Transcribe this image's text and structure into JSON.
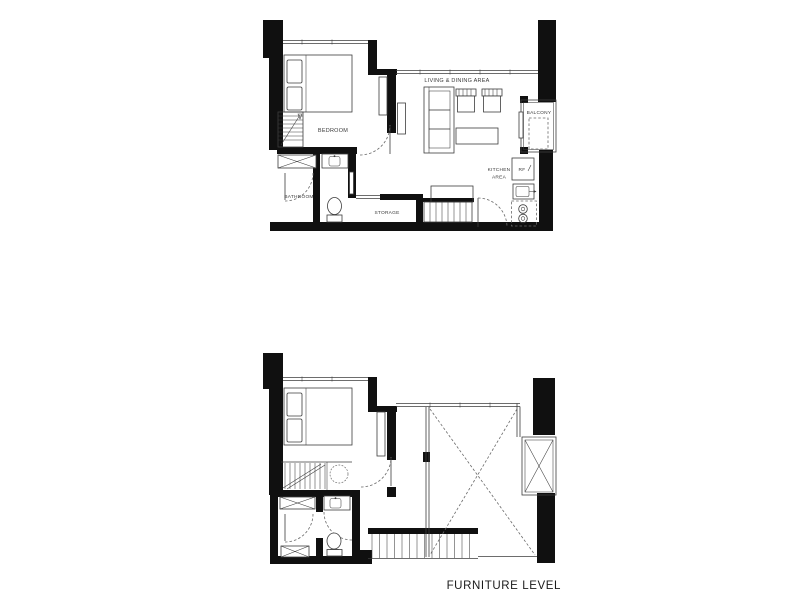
{
  "colors": {
    "background": "#ffffff",
    "wall": "#101010",
    "line": "#3c3c3c",
    "dash": "#6a6a6a",
    "label": "#3a3a3a",
    "caption": "#1a1a1a"
  },
  "sheet": {
    "caption": "FURNITURE LEVEL"
  },
  "main_level": {
    "labels": {
      "bedroom": "BEDROOM",
      "living_dining": "LIVING & DINING AREA",
      "balcony": "BALCONY",
      "kitchen_line1": "KITCHEN",
      "kitchen_line2": "AREA",
      "refrigerator": "RF",
      "bathroom": "BATHROOM",
      "storage": "STORAGE"
    }
  }
}
